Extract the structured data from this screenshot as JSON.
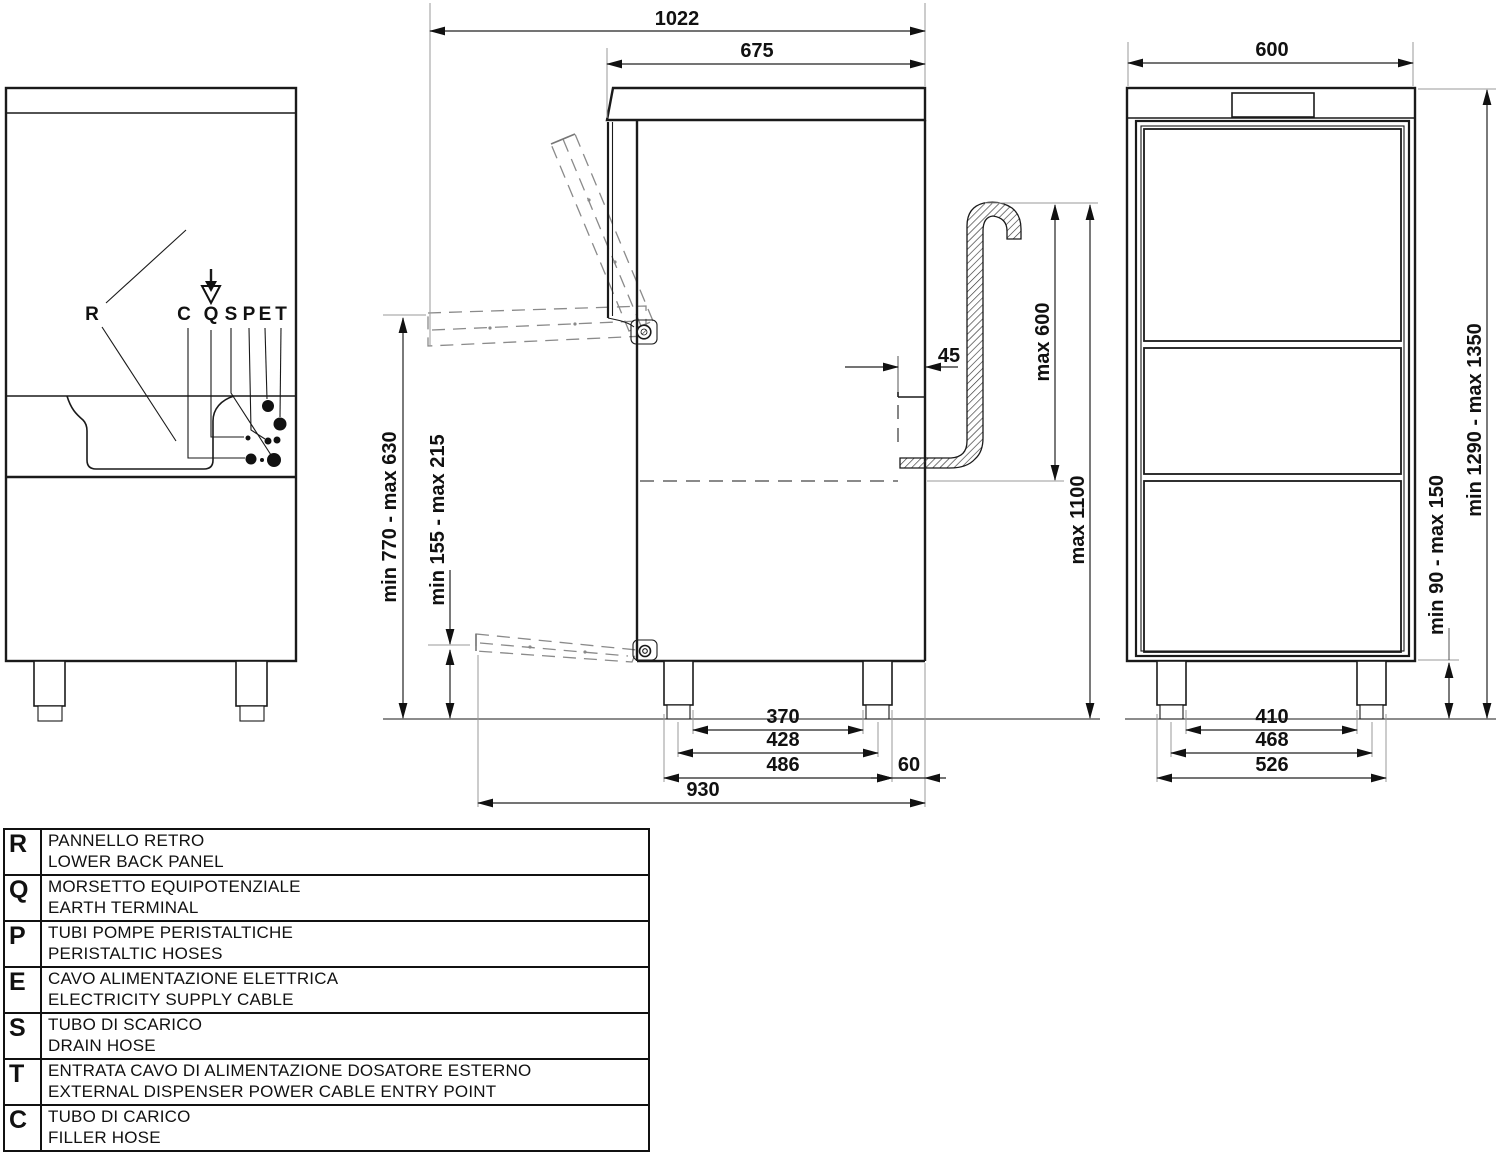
{
  "colors": {
    "ink": "#1a1a1a",
    "dashed_lines": "#8a8a8a"
  },
  "dimensions": {
    "overall_depth": "1022",
    "body_depth": "675",
    "front_width": "600",
    "door_open_height": "min 770 - max 630",
    "lower_panel_height": "min 155 - max 215",
    "drain_offset": "45",
    "standpipe_max_height": "max 600",
    "drain_max_height": "max 1100",
    "overall_height": "min 1290 - max 1350",
    "feet_height": "min 90 - max 150",
    "side_bottom": [
      "370",
      "428",
      "486",
      "60",
      "930"
    ],
    "front_bottom": [
      "410",
      "468",
      "526"
    ]
  },
  "rear_view_labels": {
    "r": "R",
    "c": "C",
    "q": "Q",
    "s": "S",
    "p": "P",
    "e": "E",
    "t": "T"
  },
  "legend": {
    "rows": [
      {
        "letter": "R",
        "it": "PANNELLO RETRO",
        "en": "LOWER BACK PANEL"
      },
      {
        "letter": "Q",
        "it": "MORSETTO EQUIPOTENZIALE",
        "en": "EARTH TERMINAL"
      },
      {
        "letter": "P",
        "it": "TUBI POMPE PERISTALTICHE",
        "en": "PERISTALTIC HOSES"
      },
      {
        "letter": "E",
        "it": "CAVO ALIMENTAZIONE ELETTRICA",
        "en": "ELECTRICITY SUPPLY CABLE"
      },
      {
        "letter": "S",
        "it": "TUBO DI SCARICO",
        "en": "DRAIN HOSE"
      },
      {
        "letter": "T",
        "it": "ENTRATA CAVO DI ALIMENTAZIONE DOSATORE ESTERNO",
        "en": "EXTERNAL DISPENSER POWER CABLE ENTRY POINT"
      },
      {
        "letter": "C",
        "it": "TUBO DI CARICO",
        "en": "FILLER HOSE"
      }
    ]
  }
}
